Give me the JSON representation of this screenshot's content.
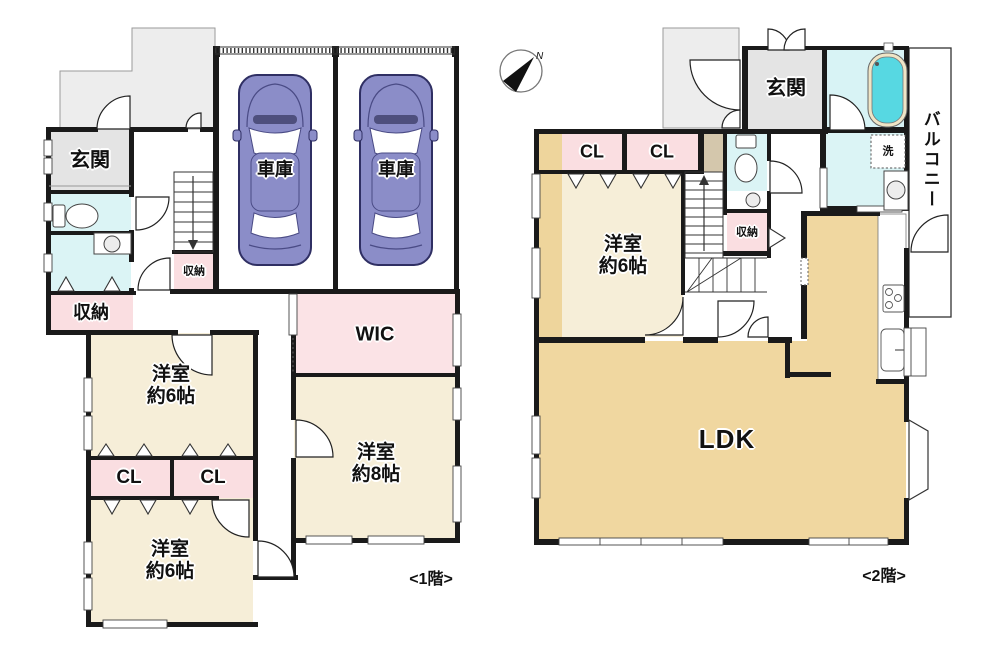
{
  "compass": {
    "north_label": "N"
  },
  "floor1": {
    "caption": "<1階>",
    "entrance": "玄関",
    "storage": "収納",
    "stair_storage": "収納",
    "garage_left": "車庫",
    "garage_right": "車庫",
    "wic": "WIC",
    "closet_left": "CL",
    "closet_right": "CL",
    "bedroom_8": {
      "name": "洋室",
      "size": "約8帖"
    },
    "bedroom_6_upper": {
      "name": "洋室",
      "size": "約6帖"
    },
    "bedroom_6_lower": {
      "name": "洋室",
      "size": "約6帖"
    }
  },
  "floor2": {
    "caption": "<2階>",
    "entrance": "玄関",
    "closet_left": "CL",
    "closet_right": "CL",
    "bedroom_6": {
      "name": "洋室",
      "size": "約6帖"
    },
    "storage": "収納",
    "laundry": "洗",
    "balcony": "バルコニー",
    "ldk": "LDK"
  },
  "colors": {
    "room_cream": "#f6eed8",
    "ldk_beige": "#f0d7a0",
    "accent_beige": "#eed59c",
    "closet_pink": "#fadee1",
    "wic_pink": "#fbe3e6",
    "wet_cyan": "#dbf4f5",
    "tub_cyan": "#57d8e2",
    "entrance_gray": "#e4e4e4",
    "porch_gray": "#ededed",
    "car_purple": "#8b8dc8",
    "wall_black": "#1a1a1a"
  }
}
